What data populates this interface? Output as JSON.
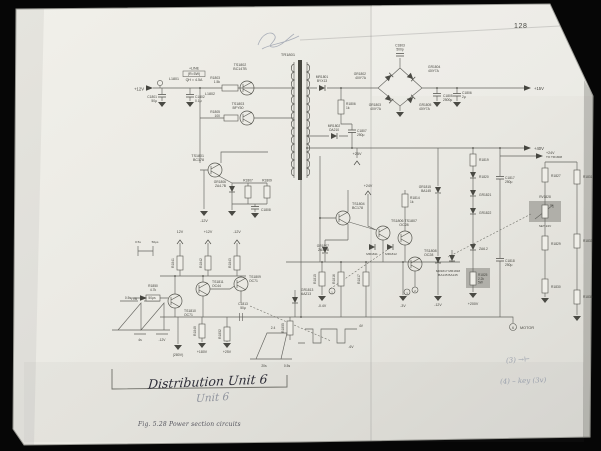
{
  "page": {
    "number": "128",
    "caption": "Fig. 5.28  Power section circuits"
  },
  "handwriting": {
    "title_ink": "Distribution Unit 6",
    "title_pencil": "Unit 6",
    "note_1": "(3) →⊢",
    "note_2": "(4) – key (3v)"
  },
  "colors": {
    "paper": "#ecebe5",
    "ink": "#45453f",
    "pencil": "#9aa0ac",
    "highlight": "#b0afa9",
    "background": "#060606"
  },
  "schematic": {
    "labels": [
      {
        "t": "+12V",
        "x": 144,
        "y": 90.5,
        "s": 4.2,
        "a": "end"
      },
      {
        "t": "L1801",
        "x": 174,
        "y": 80,
        "s": 3.6
      },
      {
        "t": "C1801",
        "x": 157,
        "y": 98,
        "s": 3.3,
        "a": "end"
      },
      {
        "t": "50μ",
        "x": 157,
        "y": 101.8,
        "s": 3.3,
        "a": "end"
      },
      {
        "t": "C1802",
        "x": 195,
        "y": 98,
        "s": 3.3,
        "a": "start"
      },
      {
        "t": "0.1μ",
        "x": 195,
        "y": 101.8,
        "s": 3.3,
        "a": "start"
      },
      {
        "t": "+LINE",
        "x": 194,
        "y": 69.5,
        "s": 3.6
      },
      {
        "t": "(R=5W)",
        "x": 194,
        "y": 75.2,
        "s": 3.6
      },
      {
        "t": "QH ≈ 4.5A",
        "x": 194,
        "y": 81,
        "s": 3.6
      },
      {
        "t": "TS1802",
        "x": 240,
        "y": 66,
        "s": 3.6
      },
      {
        "t": "BC147B",
        "x": 240,
        "y": 70.2,
        "s": 3.6
      },
      {
        "t": "R1803",
        "x": 220,
        "y": 79,
        "s": 3.3,
        "a": "end"
      },
      {
        "t": "1.5k",
        "x": 220,
        "y": 82.8,
        "s": 3.3,
        "a": "end"
      },
      {
        "t": "L1802",
        "x": 215,
        "y": 95,
        "s": 3.6,
        "a": "end"
      },
      {
        "t": "TS1803",
        "x": 238,
        "y": 105,
        "s": 3.6
      },
      {
        "t": "BFY50",
        "x": 238,
        "y": 109.2,
        "s": 3.6
      },
      {
        "t": "R1805",
        "x": 220,
        "y": 113,
        "s": 3.3,
        "a": "end"
      },
      {
        "t": "100",
        "x": 220,
        "y": 116.8,
        "s": 3.3,
        "a": "end"
      },
      {
        "t": "TR1801",
        "x": 288,
        "y": 56,
        "s": 4
      },
      {
        "t": "MR1801",
        "x": 322,
        "y": 78,
        "s": 3.3
      },
      {
        "t": "BYX13",
        "x": 322,
        "y": 81.8,
        "s": 3.3
      },
      {
        "t": "C1803",
        "x": 400,
        "y": 46.5,
        "s": 3.3
      },
      {
        "t": "500p",
        "x": 400,
        "y": 50.3,
        "s": 3.3
      },
      {
        "t": "GR1802",
        "x": 366,
        "y": 75,
        "s": 3.3,
        "a": "end"
      },
      {
        "t": "40IY7A",
        "x": 366,
        "y": 78.8,
        "s": 3.3,
        "a": "end"
      },
      {
        "t": "GR1803",
        "x": 381,
        "y": 106,
        "s": 3.3,
        "a": "end"
      },
      {
        "t": "40IY7A",
        "x": 381,
        "y": 109.8,
        "s": 3.3,
        "a": "end"
      },
      {
        "t": "GR1804",
        "x": 428,
        "y": 68,
        "s": 3.3,
        "a": "start"
      },
      {
        "t": "40IY7A",
        "x": 428,
        "y": 71.8,
        "s": 3.3,
        "a": "start"
      },
      {
        "t": "GR1805",
        "x": 419,
        "y": 106,
        "s": 3.3,
        "a": "start"
      },
      {
        "t": "40IY7A",
        "x": 419,
        "y": 109.8,
        "s": 3.3,
        "a": "start"
      },
      {
        "t": "C1805",
        "x": 443,
        "y": 97,
        "s": 3.3,
        "a": "start"
      },
      {
        "t": "2500μ",
        "x": 443,
        "y": 100.8,
        "s": 3.3,
        "a": "start"
      },
      {
        "t": "C1806",
        "x": 462,
        "y": 94,
        "s": 3.3,
        "a": "start"
      },
      {
        "t": "2μ",
        "x": 462,
        "y": 97.8,
        "s": 3.3,
        "a": "start"
      },
      {
        "t": "+15V",
        "x": 534,
        "y": 90,
        "s": 4.2,
        "a": "start"
      },
      {
        "t": "+40V",
        "x": 534,
        "y": 150,
        "s": 4.2,
        "a": "start"
      },
      {
        "t": "MR1802",
        "x": 334,
        "y": 127,
        "s": 3.3
      },
      {
        "t": "OA210",
        "x": 334,
        "y": 130.8,
        "s": 3.3
      },
      {
        "t": "R1806",
        "x": 346,
        "y": 105,
        "s": 3.3,
        "a": "start"
      },
      {
        "t": "1k",
        "x": 346,
        "y": 108.8,
        "s": 3.3,
        "a": "start"
      },
      {
        "t": "C1807",
        "x": 357,
        "y": 132,
        "s": 3.3,
        "a": "start"
      },
      {
        "t": "250μ",
        "x": 357,
        "y": 135.8,
        "s": 3.3,
        "a": "start"
      },
      {
        "t": "+25V",
        "x": 357,
        "y": 155,
        "s": 3.8
      },
      {
        "t": "TS1801",
        "x": 204,
        "y": 157,
        "s": 3.6,
        "a": "end"
      },
      {
        "t": "BC178",
        "x": 204,
        "y": 161.2,
        "s": 3.6,
        "a": "end"
      },
      {
        "t": "GR1806",
        "x": 226,
        "y": 183,
        "s": 3.3,
        "a": "end"
      },
      {
        "t": "ZA4.7B",
        "x": 226,
        "y": 186.8,
        "s": 3.3,
        "a": "end"
      },
      {
        "t": "R1807",
        "x": 248,
        "y": 181.5,
        "s": 3.3
      },
      {
        "t": "R1809",
        "x": 267,
        "y": 181.5,
        "s": 3.3
      },
      {
        "t": "C1808",
        "x": 261,
        "y": 211,
        "s": 3.3,
        "a": "start"
      },
      {
        "t": "-12V",
        "x": 204,
        "y": 222,
        "s": 3.6
      },
      {
        "t": "12V",
        "x": 180,
        "y": 233,
        "s": 3.6
      },
      {
        "t": "+12V",
        "x": 208,
        "y": 233,
        "s": 3.6
      },
      {
        "t": "-12V",
        "x": 237,
        "y": 233,
        "s": 3.6
      },
      {
        "t": "R1841",
        "x": 174,
        "y": 263,
        "s": 3.3,
        "r": -90
      },
      {
        "t": "R1842",
        "x": 202,
        "y": 263,
        "s": 3.3,
        "r": -90
      },
      {
        "t": "R1843",
        "x": 231,
        "y": 263,
        "s": 3.3,
        "r": -90
      },
      {
        "t": "TS1804",
        "x": 352,
        "y": 205,
        "s": 3.6,
        "a": "start"
      },
      {
        "t": "BC178",
        "x": 352,
        "y": 209.2,
        "s": 3.6,
        "a": "start"
      },
      {
        "t": "+24V",
        "x": 368,
        "y": 187,
        "s": 3.6
      },
      {
        "t": "R1814",
        "x": 410,
        "y": 199,
        "s": 3.3,
        "a": "start"
      },
      {
        "t": "1k",
        "x": 410,
        "y": 202.8,
        "s": 3.3,
        "a": "start"
      },
      {
        "t": "TS1806  TS1807",
        "x": 404,
        "y": 222,
        "s": 3.6
      },
      {
        "t": "OC28",
        "x": 404,
        "y": 226.2,
        "s": 3.6
      },
      {
        "t": "MR1811",
        "x": 372,
        "y": 255,
        "s": 3.1
      },
      {
        "t": "MR1812",
        "x": 391,
        "y": 255,
        "s": 3.1
      },
      {
        "t": "GR1807",
        "x": 329,
        "y": 247,
        "s": 3.3,
        "a": "end"
      },
      {
        "t": "ZA4.7B",
        "x": 329,
        "y": 250.8,
        "s": 3.3,
        "a": "end"
      },
      {
        "t": "TS1808",
        "x": 424,
        "y": 252,
        "s": 3.6,
        "a": "start"
      },
      {
        "t": "OC28",
        "x": 424,
        "y": 256.2,
        "s": 3.6,
        "a": "start"
      },
      {
        "t": "MR1817 MR1818",
        "x": 448,
        "y": 272,
        "s": 3.1
      },
      {
        "t": "BA145  BA145",
        "x": 448,
        "y": 275.8,
        "s": 3.1
      },
      {
        "t": "GR1815",
        "x": 431,
        "y": 188,
        "s": 3.3,
        "a": "end"
      },
      {
        "t": "BA145",
        "x": 431,
        "y": 191.8,
        "s": 3.3,
        "a": "end"
      },
      {
        "t": "R1819",
        "x": 479,
        "y": 161,
        "s": 3.3,
        "a": "start"
      },
      {
        "t": "R1820",
        "x": 479,
        "y": 178,
        "s": 3.3,
        "a": "start"
      },
      {
        "t": "GR1821",
        "x": 479,
        "y": 196,
        "s": 3.3,
        "a": "start"
      },
      {
        "t": "GR1822",
        "x": 479,
        "y": 214,
        "s": 3.3,
        "a": "start"
      },
      {
        "t": "ZA6.2",
        "x": 479,
        "y": 250,
        "s": 3.3,
        "a": "start"
      },
      {
        "t": "R1825",
        "x": 478,
        "y": 276,
        "s": 3.2,
        "a": "start"
      },
      {
        "t": "2.2k",
        "x": 478,
        "y": 279.8,
        "s": 3.2,
        "a": "start"
      },
      {
        "t": "5W",
        "x": 478,
        "y": 283.6,
        "s": 3.2,
        "a": "start"
      },
      {
        "t": "+200V",
        "x": 473,
        "y": 305,
        "s": 3.6
      },
      {
        "t": "C1817",
        "x": 505,
        "y": 179,
        "s": 3.3,
        "a": "start"
      },
      {
        "t": "250μ",
        "x": 505,
        "y": 182.8,
        "s": 3.3,
        "a": "start"
      },
      {
        "t": "C1818",
        "x": 505,
        "y": 262,
        "s": 3.3,
        "a": "start"
      },
      {
        "t": "250μ",
        "x": 505,
        "y": 265.8,
        "s": 3.3,
        "a": "start"
      },
      {
        "t": "+24V",
        "x": 546,
        "y": 154,
        "s": 3.6,
        "a": "start"
      },
      {
        "t": "TO TR1808",
        "x": 546,
        "y": 158.2,
        "s": 3.1,
        "a": "start"
      },
      {
        "t": "R1827",
        "x": 551,
        "y": 177,
        "s": 3.3,
        "a": "start"
      },
      {
        "t": "RV1828",
        "x": 545,
        "y": 198,
        "s": 3.2
      },
      {
        "t": "SET 24V",
        "x": 545,
        "y": 227,
        "s": 3.1
      },
      {
        "t": "R1829",
        "x": 551,
        "y": 245,
        "s": 3.3,
        "a": "start"
      },
      {
        "t": "R1830",
        "x": 551,
        "y": 288,
        "s": 3.3,
        "a": "start"
      },
      {
        "t": "R1831",
        "x": 583,
        "y": 178,
        "s": 3.2,
        "a": "start"
      },
      {
        "t": "R1833",
        "x": 583,
        "y": 242,
        "s": 3.2,
        "a": "start"
      },
      {
        "t": "R1835",
        "x": 583,
        "y": 298,
        "s": 3.2,
        "a": "start"
      },
      {
        "t": "MOTOR",
        "x": 520,
        "y": 329,
        "s": 3.8,
        "a": "start"
      },
      {
        "t": "-0.4V",
        "x": 322,
        "y": 307,
        "s": 3.5
      },
      {
        "t": "-3V",
        "x": 403,
        "y": 307,
        "s": 3.5
      },
      {
        "t": "-12V",
        "x": 438,
        "y": 306,
        "s": 3.5
      },
      {
        "t": "(280V)",
        "x": 178,
        "y": 356,
        "s": 3.5
      },
      {
        "t": "+180V",
        "x": 202,
        "y": 353,
        "s": 3.5
      },
      {
        "t": "+25V",
        "x": 227,
        "y": 353,
        "s": 3.5
      },
      {
        "t": "F/B",
        "x": 137,
        "y": 300,
        "s": 3.8,
        "a": "end"
      },
      {
        "t": "R1850",
        "x": 153,
        "y": 287,
        "s": 3.3
      },
      {
        "t": "4.7k",
        "x": 153,
        "y": 290.8,
        "s": 3.3
      },
      {
        "t": "TS1810",
        "x": 184,
        "y": 312,
        "s": 3.4,
        "a": "start"
      },
      {
        "t": "OC71",
        "x": 184,
        "y": 316,
        "s": 3.4,
        "a": "start"
      },
      {
        "t": "TS1811",
        "x": 212,
        "y": 283,
        "s": 3.4,
        "a": "start"
      },
      {
        "t": "OC44",
        "x": 212,
        "y": 287,
        "s": 3.4,
        "a": "start"
      },
      {
        "t": "TS1809",
        "x": 249,
        "y": 278,
        "s": 3.4,
        "a": "start"
      },
      {
        "t": "OC71",
        "x": 249,
        "y": 282,
        "s": 3.4,
        "a": "start"
      },
      {
        "t": "C1813",
        "x": 243,
        "y": 305,
        "s": 3.3
      },
      {
        "t": "50μ",
        "x": 243,
        "y": 308.8,
        "s": 3.3
      },
      {
        "t": "GR1813",
        "x": 301,
        "y": 291,
        "s": 3.3,
        "a": "start"
      },
      {
        "t": "AAZ13",
        "x": 301,
        "y": 294.8,
        "s": 3.3,
        "a": "start"
      },
      {
        "t": "R1849",
        "x": 196,
        "y": 331,
        "s": 3.3,
        "r": -90
      },
      {
        "t": "R1852",
        "x": 221,
        "y": 334,
        "s": 3.3,
        "r": -90
      },
      {
        "t": "R1855",
        "x": 284,
        "y": 328,
        "s": 3.3,
        "r": -90
      },
      {
        "t": "R1815",
        "x": 316,
        "y": 279,
        "s": 3.3,
        "r": -90
      },
      {
        "t": "R1816",
        "x": 335,
        "y": 279,
        "s": 3.3,
        "r": -90
      },
      {
        "t": "R1817",
        "x": 360,
        "y": 279,
        "s": 3.3,
        "r": -90
      },
      {
        "t": "0.5s",
        "x": 128,
        "y": 299,
        "s": 3.3
      },
      {
        "t": "50μs",
        "x": 152,
        "y": 299,
        "s": 3.3
      },
      {
        "t": "4s",
        "x": 140,
        "y": 341,
        "s": 3.3
      },
      {
        "t": "-12V",
        "x": 162,
        "y": 341,
        "s": 3.3
      },
      {
        "t": "4V",
        "x": 361,
        "y": 327,
        "s": 3.3
      },
      {
        "t": "-6V",
        "x": 351,
        "y": 348,
        "s": 3.3
      },
      {
        "t": "2.4",
        "x": 273,
        "y": 329,
        "s": 3.3
      },
      {
        "t": "20s",
        "x": 264,
        "y": 367,
        "s": 3.3
      },
      {
        "t": "0.5s",
        "x": 287,
        "y": 367,
        "s": 3.3
      },
      {
        "t": "0.5s",
        "x": 138,
        "y": 243,
        "s": 3.1
      },
      {
        "t": "50μs",
        "x": 155,
        "y": 243,
        "s": 3.1
      },
      {
        "t": "1",
        "x": 332,
        "y": 293.3,
        "s": 3.1
      },
      {
        "t": "3",
        "x": 407,
        "y": 294.3,
        "s": 3.1
      },
      {
        "t": "2",
        "x": 415,
        "y": 291.8,
        "s": 3.1
      },
      {
        "t": "6",
        "x": 513,
        "y": 328.8,
        "s": 3.3
      }
    ]
  }
}
